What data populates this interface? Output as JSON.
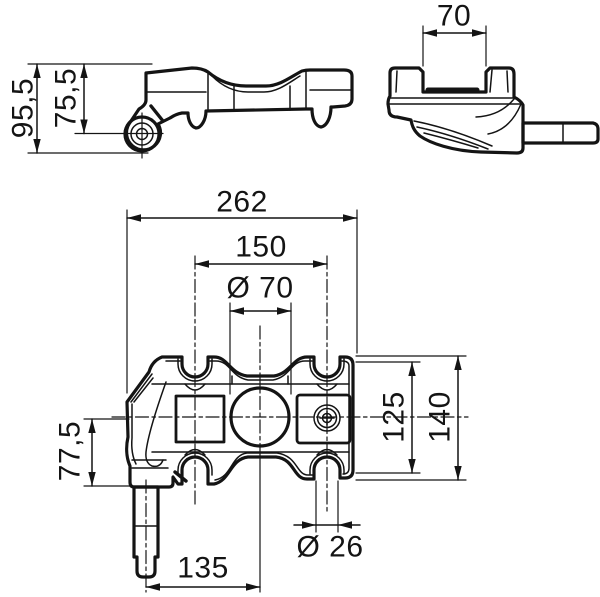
{
  "colors": {
    "background": "#ffffff",
    "part_fill": "#a7dbf2",
    "bore_fill": "#ffffff",
    "outline": "#141414",
    "dimension_color": "#141414"
  },
  "dimensions": {
    "total_height": "95,5",
    "height_to_axis": "75,5",
    "slot_width": "70",
    "overall_width": "262",
    "bolt_spacing": "150",
    "bore_diameter": "Ø 70",
    "flange_inner_height": "125",
    "flange_outer_height": "140",
    "arm_height": "77,5",
    "pin_offset": "135",
    "slot_diameter": "Ø 26"
  }
}
